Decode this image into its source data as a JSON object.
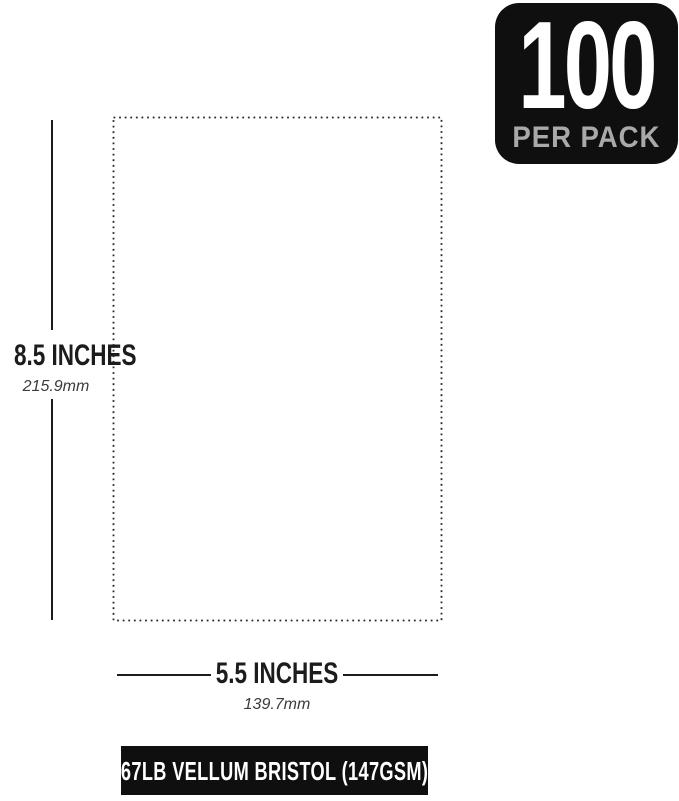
{
  "badge": {
    "count": "100",
    "label": "PER PACK",
    "bg_color": "#0f0f0f",
    "count_color": "#ffffff",
    "label_color": "#a9a9a9"
  },
  "sheet": {
    "height": {
      "inches": "8.5 INCHES",
      "mm": "215.9mm"
    },
    "width": {
      "inches": "5.5 INCHES",
      "mm": "139.7mm"
    }
  },
  "footer": {
    "label": "67LB VELLUM BRISTOL (147GSM)",
    "bg_color": "#0f0f0f",
    "text_color": "#ffffff"
  },
  "colors": {
    "background": "#ffffff",
    "dimension_line": "#1c1c1c",
    "dotted_outline": "#262626",
    "mm_text": "#3c3c3c"
  }
}
